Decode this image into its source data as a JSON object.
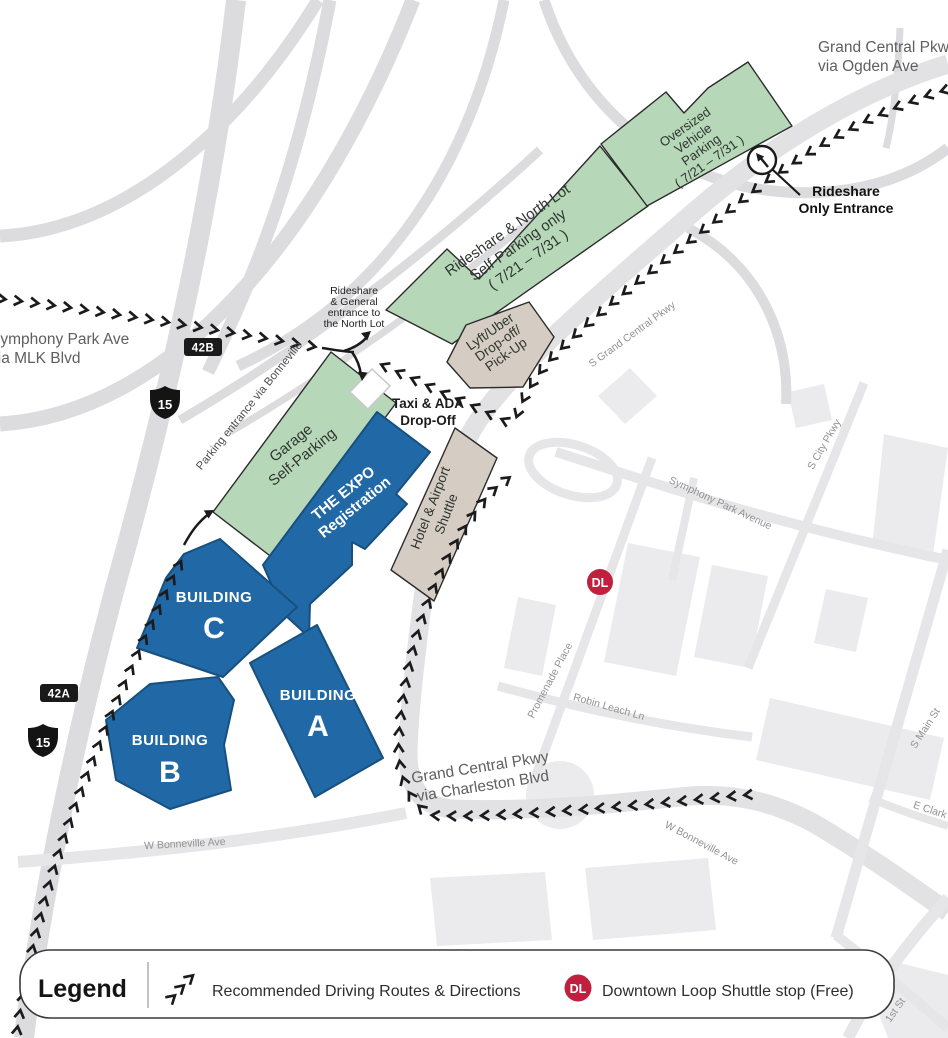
{
  "colors": {
    "building_blue": "#2169a6",
    "lot_green": "#b7d8b8",
    "shuttle_tan": "#d5cdc3",
    "dl_red": "#c0203e",
    "route_black": "#1b1b1d"
  },
  "route_labels": {
    "ogden": [
      "Grand Central Pkwy",
      "via Ogden Ave"
    ],
    "mlk": [
      "Symphony Park Ave",
      "via MLK Blvd"
    ],
    "charleston": [
      "Grand Central Pkwy",
      "via Charleston Blvd"
    ]
  },
  "shields": {
    "interstate": "15",
    "exit_b": "42B",
    "exit_a": "42A"
  },
  "lots": {
    "north": [
      "Rideshare & North Lot",
      "Self-Parking only",
      "( 7/21 – 7/31 )"
    ],
    "oversized": [
      "Oversized",
      "Vehicle",
      "Parking",
      "( 7/21 – 7/31 )"
    ],
    "garage": [
      "Garage",
      "Self-Parking"
    ],
    "lyft": [
      "Lyft/Uber",
      "Drop-off/",
      "Pick-Up"
    ],
    "hotel": [
      "Hotel & Airport",
      "Shuttle"
    ]
  },
  "buildings": {
    "expo": [
      "THE EXPO",
      "Registration"
    ],
    "a": {
      "word": "BUILDING",
      "letter": "A"
    },
    "b": {
      "word": "BUILDING",
      "letter": "B"
    },
    "c": {
      "word": "BUILDING",
      "letter": "C"
    }
  },
  "callouts": {
    "rideshare_only": [
      "Rideshare",
      "Only Entrance"
    ],
    "north_entrance": [
      "Rideshare",
      "& General",
      "entrance to",
      "the North Lot"
    ],
    "taxi": [
      "Taxi & ADA",
      "Drop-Off"
    ],
    "parking_entrance": "Parking entrance via Bonneville"
  },
  "streets": {
    "s_grand_central": "S Grand Central Pkwy",
    "symphony": "Symphony Park Avenue",
    "s_city": "S City Pkwy",
    "promenade": "Promenade Place",
    "robin_leach": "Robin Leach Ln",
    "bonneville_left": "W Bonneville Ave",
    "bonneville_right": "W Bonneville Ave",
    "s_main": "S Main St",
    "e_clark": "E Clark",
    "first_st": "1st St"
  },
  "badges": {
    "dl": "DL"
  },
  "legend": {
    "title": "Legend",
    "route_item": "Recommended Driving Routes & Directions",
    "dl_badge": "DL",
    "dl_item": "Downtown Loop Shuttle stop (Free)"
  }
}
